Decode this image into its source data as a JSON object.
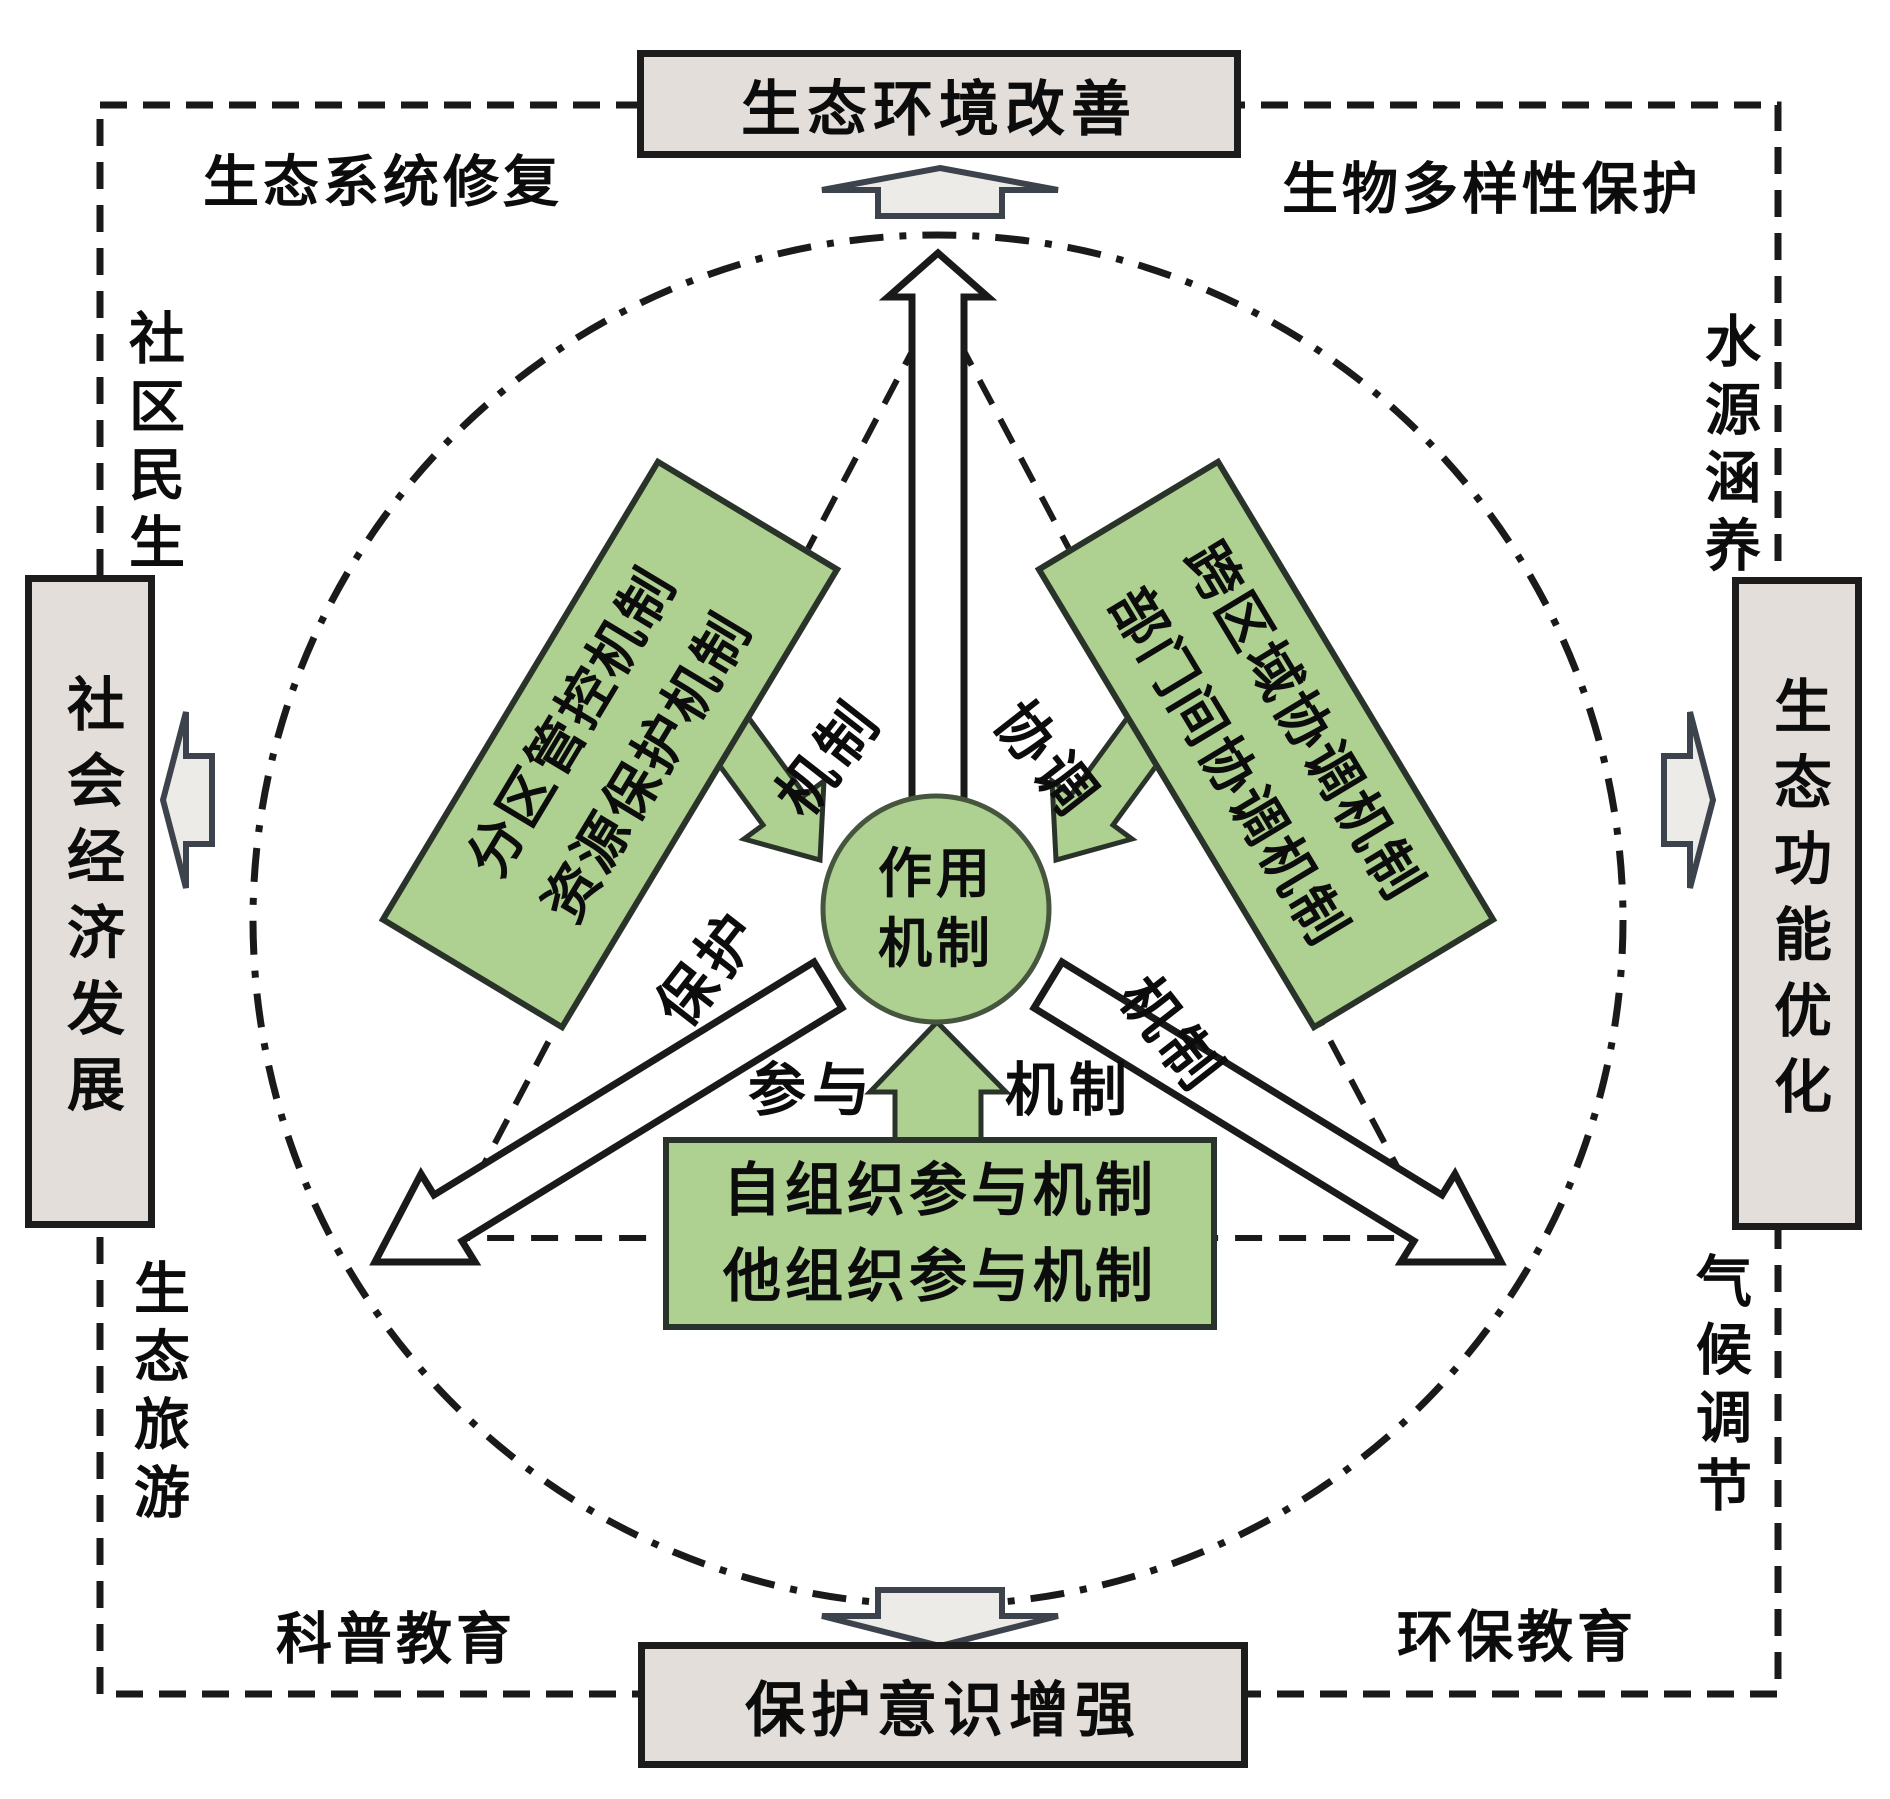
{
  "colors": {
    "green_fill": "#aed191",
    "green_border": "#2a332a",
    "circle_border": "#46553e",
    "gray_box_fill": "#e3deda",
    "gray_box_border": "#1c1c1c",
    "gray_arrow_fill": "#edebe8",
    "gray_arrow_border": "#3c434c",
    "line_color": "#1a1a1a",
    "text_color": "#0c0c0c"
  },
  "outcome_boxes": {
    "top": "生态环境改善",
    "right": "生态功能优化",
    "bottom": "保护意识增强",
    "left": "社会经济发展"
  },
  "corner_labels": {
    "top_left": "生态系统修复",
    "top_right": "生物多样性保护",
    "left_upper": "社区民生",
    "right_upper": "水源涵养",
    "left_lower": "生态旅游",
    "right_lower": "气候调节",
    "bottom_left": "科普教育",
    "bottom_right": "环保教育"
  },
  "center_circle": {
    "line1": "作用",
    "line2": "机制"
  },
  "mechanism_boxes": {
    "upper_left": {
      "line1": "分区管控机制",
      "line2": "资源保护机制"
    },
    "upper_right": {
      "line1": "跨区域协调机制",
      "line2": "部门间协调机制"
    },
    "bottom": {
      "line1": "自组织参与机制",
      "line2": "他组织参与机制"
    }
  },
  "arrow_labels": {
    "protection": {
      "part1": "保护",
      "part2": "机制"
    },
    "coordination": {
      "part1": "协调",
      "part2": "机制"
    },
    "participation": {
      "part1": "参与",
      "part2": "机制"
    }
  }
}
